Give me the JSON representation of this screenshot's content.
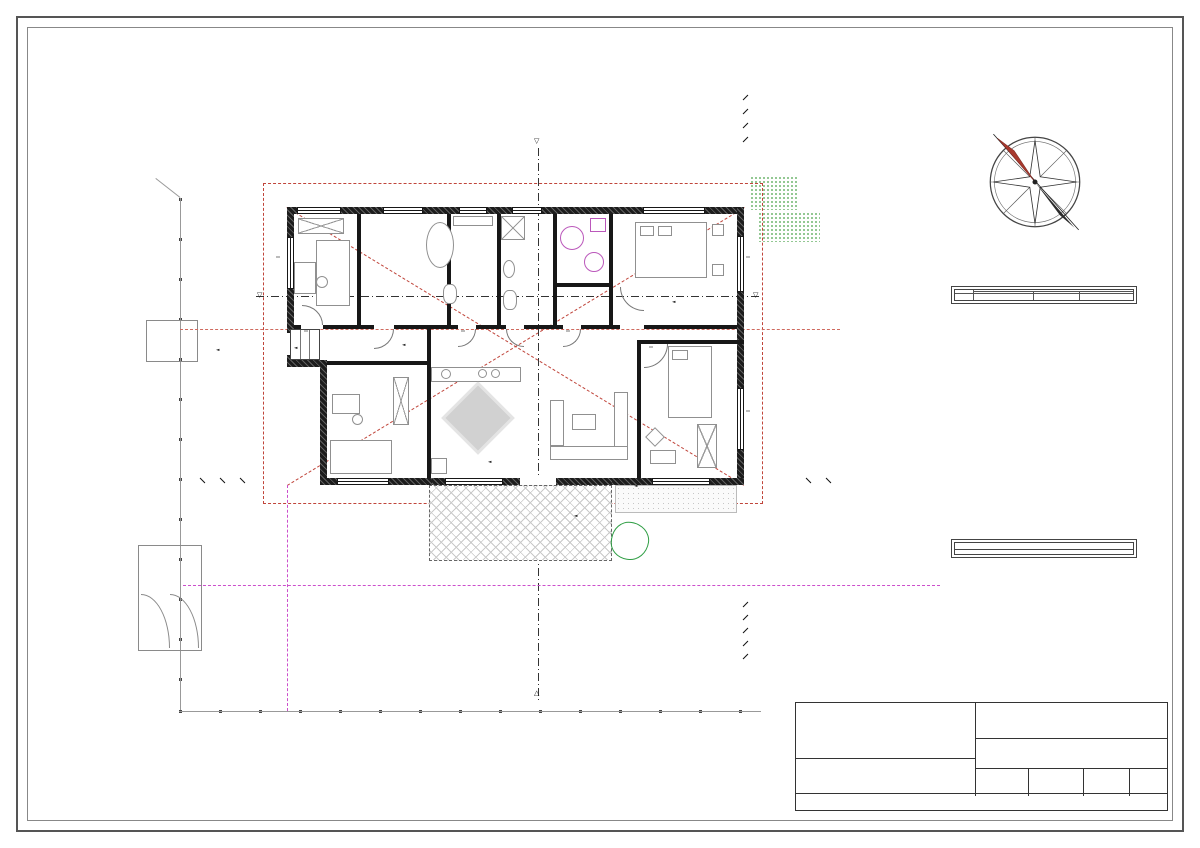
{
  "title": {
    "main": "ALAPRAJZ",
    "scale": "M=1:100"
  },
  "watermark": {
    "text": "DUNA HOUSE"
  },
  "room_table": {
    "title": "Az ÉPÜLET helyiségei",
    "col_jele": "jele",
    "col_rendeltetese": "rendeltetése",
    "col_alapterulet": "alapterület",
    "col_padlo": "padlóburkolata",
    "rows": [
      {
        "jele": "01.",
        "name": "SZÉLFOGÓ",
        "area": "4,48 m²",
        "floor": "greslap"
      },
      {
        "jele": "02.",
        "name": "SZOBA.1",
        "area": "11,52 m²",
        "floor": "lam.parketta"
      },
      {
        "jele": "03.",
        "name": "SZOBA.2",
        "area": "9,12 m²",
        "floor": "lam.parketta"
      },
      {
        "jele": "04.",
        "name": "FÜRDŐ",
        "area": "7,04 m²",
        "floor": "greslap"
      },
      {
        "jele": "05.",
        "name": "NAPPALI",
        "area": "30,04 m²",
        "floor": "greslap"
      },
      {
        "jele": "06.",
        "name": "KONYHA",
        "area": "6,93 m²",
        "floor": "greslap"
      },
      {
        "jele": "07.",
        "name": "SZOBA.3",
        "area": "13,76 m²",
        "floor": "greslap"
      },
      {
        "jele": "08.",
        "name": "KAMRA",
        "area": "3,84 m²",
        "floor": "greslap"
      },
      {
        "jele": "09.",
        "name": "ET.",
        "area": "2,20 m²",
        "floor": "greslap"
      },
      {
        "jele": "10.",
        "name": "SZOBA.4",
        "area": "12,60 m²",
        "floor": "lam.parketta"
      },
      {
        "jele": "11.",
        "name": "HTH+GÉP.",
        "area": "4,00 m²",
        "floor": "greslap"
      },
      {
        "jele": "12.",
        "name": "WC+ZUH.",
        "area": "5,76 m²",
        "floor": "greslap"
      }
    ],
    "total_label": "ÖSSZESEN:",
    "total_value": "111,29 m²",
    "extra_rows": [
      {
        "jele": "13.",
        "name": "ELÉPCSŐ",
        "area": "2,10 m²",
        "floor": "f.á.greslap"
      },
      {
        "jele": "14.",
        "name": "TERASZ",
        "area": "15,00 m²",
        "floor": "f.á.greslap"
      }
    ]
  },
  "materials": {
    "title": "ANYAGHASZNÁLAT:",
    "items": [
      {
        "pattern": "brick-hatch",
        "label": "-tégla falazat"
      },
      {
        "pattern": "insulation-grid",
        "label": "-hőszigetelő rendszer"
      },
      {
        "pattern": "rc-speckle",
        "label": "-vasbeton szerkezet"
      },
      {
        "pattern": "concrete-speckle",
        "label": "-beton szerkezet"
      },
      {
        "pattern": "wood-solid",
        "label": "-fa szerkezet"
      }
    ]
  },
  "title_block": {
    "epitteto_label": "ÉPÍTTETŐ:",
    "tervezo_label": "TERVEZŐ:",
    "tervezo_name": "Sándor Csaba András,",
    "tervezo_reg": "É3 13-1490",
    "tervezo_addr": "2220 Vecsés Tündér u. 8.",
    "tervezo_contact": "kacsa55ter@gmail.com; +36205504021",
    "terv_label": "TERV MEGNEVEZÉSE:",
    "terv_name1": "EGYLAKÁSOS LAKÓÉPÜLET ÉPÍTÉSÉNEK",
    "terv_name2": "BEJELENTÉSI DOKUMENTÁCIÓJA",
    "helye_label": "ÉPÍTÉS HELYE:",
    "datum_label": "DÁTUM:",
    "leptek_label": "LÉPTÉK:",
    "leptek_value": "M = 1 : 100",
    "rajz_label": "RAJZ:",
    "rajz_value": "Alaprajzok",
    "rajzjele_label": "RAJZ JELE:",
    "rajzjele_value": "E - 1/1",
    "copyright": "Ezen tervdokumentáció a tervező szellemi terméke, szerzői jogi védelem alatt áll."
  },
  "plan_rooms": [
    {
      "name": "SZÉLFOGÓ",
      "floor": "greslap",
      "area": "4,48 m²"
    },
    {
      "name": "SZOBA.1",
      "floor": "lam.parketta",
      "area": "11,52 m²"
    },
    {
      "name": "SZOBA.2",
      "floor": "lam.parketta",
      "area": "9,12 m²"
    },
    {
      "name": "FÜRDŐ",
      "floor": "greslap",
      "area": "7,04 m²"
    },
    {
      "name": "NAPPALI",
      "floor": "greslap",
      "area": "30,04 m²"
    },
    {
      "name": "KONYHA",
      "floor": "greslap",
      "area": "6,93 m²"
    },
    {
      "name": "SZOBA.3",
      "floor": "greslap",
      "area": "13,76 m²"
    },
    {
      "name": "KRA.",
      "floor": "greslap",
      "area": "3,84 m²"
    },
    {
      "name": "ET.",
      "floor": "greslap",
      "area": "2,20 m²"
    },
    {
      "name": "SZOBA.4",
      "floor": "lam.parketta",
      "area": "12,60 m²"
    },
    {
      "name": "HTH+GÉP.",
      "floor": "greslap",
      "area": "4,00 m²"
    },
    {
      "name": "WC+ZUH.",
      "floor": "greslap",
      "area": "5,76 m²"
    },
    {
      "name": "E.LÉPCS.",
      "floor": "",
      "area": ""
    },
    {
      "name": "TERASZ",
      "floor": "greslap",
      "area": "15,00 m²"
    }
  ],
  "levels": [
    "±0,00",
    "+0,45",
    "+0,45",
    "+0,43",
    "m±0,00  m±0,00",
    "+0,00",
    "+0,43"
  ],
  "sections": {
    "a": "A",
    "b": "B"
  },
  "size_labels": [
    {
      "a": "90",
      "b": "210"
    },
    {
      "a": "150",
      "b": "150"
    }
  ],
  "lintels": [
    "m1,80",
    "m1,80"
  ],
  "plan_dims": [
    "5,00",
    "4,30",
    "3,00",
    "7,00",
    "2,80",
    "6,57"
  ],
  "annotations": {
    "jogi": "jogi telekhatár",
    "oldalkert": "4,5 m oldalkert",
    "elokert": "3,0 m előkert",
    "corner1": "Tsz.613.31",
    "corner2": "2.873,6,19",
    "anno_left1": "-P.V.30 klíma",
    "anno_left2": "-90 mm p.k.bevonat",
    "anno_right1": "előtető, csapadék",
    "anno_right2": "bekötés Ø-be elvezetve",
    "anno_mag1": "csapadékvíz bekötés",
    "anno_mag2": "'zöld' ágba"
  },
  "dims": {
    "top": [
      {
        "segs": [
          "15,70"
        ]
      },
      {
        "segs": [
          "10",
          "15,50",
          "10"
        ]
      },
      {
        "segs": [
          "30",
          "3,40",
          "10",
          "2,20",
          "10",
          "1,20",
          "10",
          "1,80",
          "10",
          "2,00",
          "10",
          "3,40",
          "30"
        ]
      },
      {
        "segs": [
          "4,10",
          "90",
          "1,45",
          "90",
          "1,35",
          "90",
          "75",
          "90",
          "4,55"
        ]
      }
    ],
    "bottom": [
      {
        "segs": [
          "1,20",
          "4,00",
          "90",
          "1,05",
          "90",
          "90",
          "90",
          "3,00",
          "1,20",
          "1,05"
        ]
      },
      {
        "segs": [
          "1,20",
          "30",
          "2,80",
          "10",
          "2,50",
          "5,50",
          "10",
          "2,00",
          "30"
        ]
      },
      {
        "segs": [
          "1,20",
          "14,20"
        ]
      },
      {
        "segs": [
          "10",
          "15,50",
          "10"
        ]
      },
      {
        "segs": [
          "15,70"
        ]
      }
    ],
    "left": [
      {
        "segs": [
          "9,50"
        ]
      },
      {
        "segs": [
          "3,80",
          "3,20",
          "2,50"
        ]
      },
      {
        "segs": [
          "10",
          "1,50",
          "1,15",
          "30",
          "1,15",
          "1,60",
          "1,40",
          "1,10"
        ]
      }
    ],
    "right": [
      {
        "segs": [
          "1,80",
          "6,80",
          "80"
        ]
      },
      {
        "segs": [
          "9,30"
        ]
      }
    ]
  }
}
